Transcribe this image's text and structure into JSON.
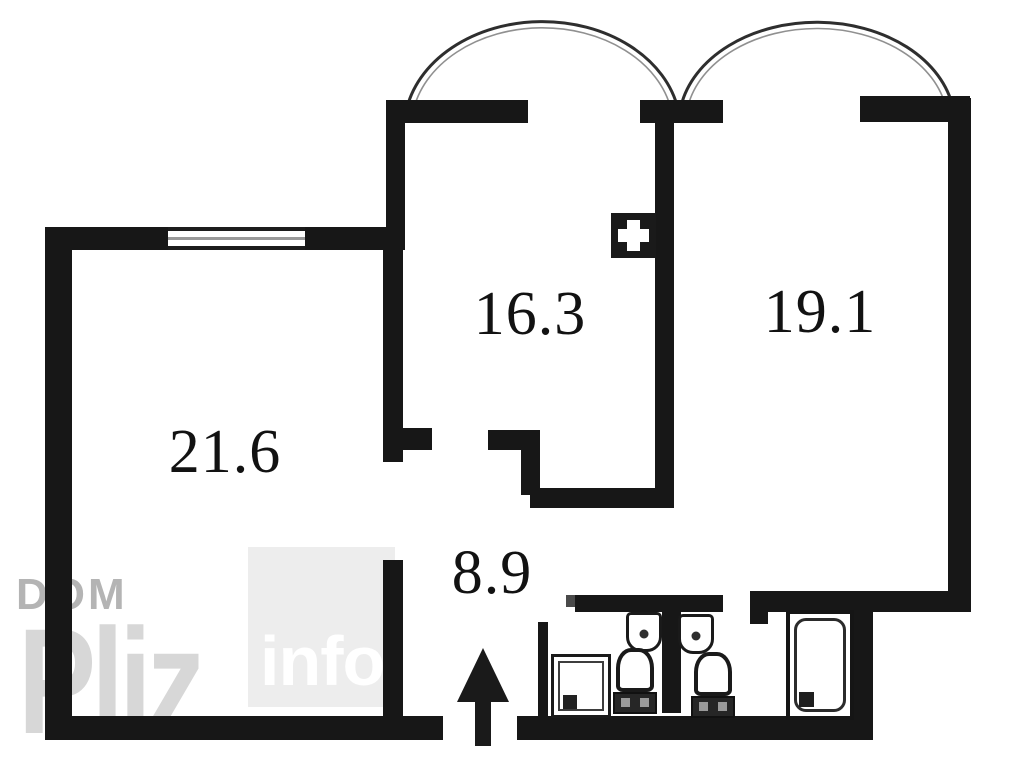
{
  "meta": {
    "type": "apartment floor plan",
    "style": "black-and-white architectural drawing with watermark"
  },
  "rooms": [
    {
      "id": "living-room",
      "area_label": "21.6"
    },
    {
      "id": "room-center",
      "area_label": "16.3"
    },
    {
      "id": "room-right",
      "area_label": "19.1"
    },
    {
      "id": "hallway",
      "area_label": "8.9"
    }
  ],
  "watermark": {
    "brand_top": "DOM",
    "brand_main": "Pliz",
    "brand_suffix": "info"
  },
  "colors": {
    "wall": "#171717",
    "background": "#ffffff",
    "room_label": "#121212",
    "watermark_gray": "#b4b4b4",
    "watermark_light": "#d7d7d7",
    "watermark_box": "#ededed",
    "watermark_text": "#ffffff"
  },
  "symbols": [
    "balcony-arc",
    "balcony-arc",
    "window",
    "ventilation-shaft",
    "washing-machine",
    "sink",
    "sink",
    "toilet",
    "toilet",
    "bathtub",
    "entrance-arrow"
  ]
}
